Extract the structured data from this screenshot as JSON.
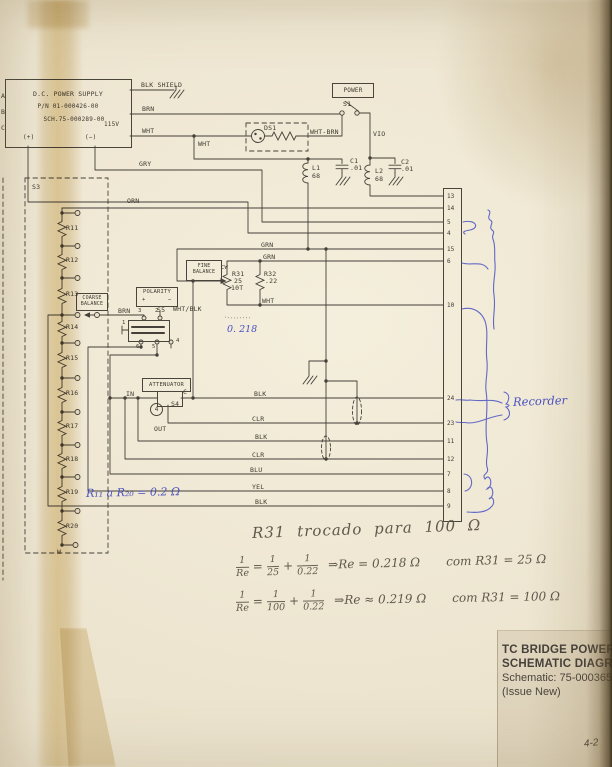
{
  "title_block": {
    "product": "TC BRIDGE POWER UNIT",
    "doc": "SCHEMATIC DIAGRAM",
    "schematic": "Schematic: 75-000365-00",
    "issue": "(Issue New)",
    "page": "4-2"
  },
  "power_supply": {
    "title": "D.C. POWER SUPPLY",
    "part": "P/N 01-000426-00",
    "sch": "SCH.75-000289-00",
    "voltage": "115V",
    "plus": "(+)",
    "minus": "(−)",
    "a": "A",
    "b": "B",
    "c": "C"
  },
  "wires": {
    "blk_shield": "BLK SHIELD",
    "brn": "BRN",
    "wht": "WHT",
    "wht_b": "WHT",
    "gry": "GRY",
    "orn": "ORN",
    "wht_brn": "WHT-BRN",
    "vio": "VIO",
    "grn_a": "GRN",
    "grn_b": "GRN",
    "wht_c": "WHT",
    "wht_blk": "WHT/BLK",
    "brn_b": "BRN",
    "blk_a": "BLK",
    "clr_a": "CLR",
    "blk_b": "BLK",
    "clr_b": "CLR",
    "blu": "BLU",
    "yel": "YEL",
    "blk_c": "BLK"
  },
  "components": {
    "power": "POWER",
    "s1": "S1",
    "ds1": "DS1",
    "s3": "S3",
    "s4": "S4",
    "s5": "S5",
    "l1": {
      "ref": "L1",
      "val": "68"
    },
    "l2": {
      "ref": "L2",
      "val": "68"
    },
    "c1": {
      "ref": "C1",
      "val": ".01"
    },
    "c2": {
      "ref": "C2",
      "val": ".01"
    },
    "r31": {
      "ref": "R31",
      "val": "25",
      "turns": "10T"
    },
    "r32": {
      "ref": "R32",
      "val": ".22"
    },
    "fine_balance": {
      "l1": "FINE",
      "l2": "BALANCE",
      "cw": "CW"
    },
    "coarse_balance": {
      "l1": "COARSE",
      "l2": "BALANCE"
    },
    "polarity": {
      "title": "POLARITY",
      "plus": "+",
      "minus": "−"
    },
    "attenuator": {
      "title": "ATTENUATOR",
      "in": "IN",
      "c": "C",
      "out": "OUT",
      "knob": "4"
    },
    "s5_pins": {
      "p1": "1",
      "p2": "2",
      "p3": "3",
      "p4": "4",
      "p5": "5",
      "p6": "6"
    },
    "ladder": {
      "r": [
        "R11",
        "R12",
        "R13",
        "R14",
        "R15",
        "R16",
        "R17",
        "R18",
        "R19",
        "R20"
      ],
      "w": "W"
    }
  },
  "connector": {
    "pins": [
      "13",
      "14",
      "5",
      "4",
      "15",
      "6",
      "10",
      "24",
      "23",
      "11",
      "12",
      "7",
      "8",
      "9"
    ]
  },
  "annotations": {
    "recorder": "Recorder",
    "ladder_note": "R₁₁ a R₂₀ = 0.2 Ω",
    "pot_note": "0. 218",
    "note_title": "R31 trocado para 100 Ω",
    "eq1": {
      "n1": "1",
      "d1": "Re",
      "eq": "=",
      "n2": "1",
      "d2": "25",
      "plus": "+",
      "n3": "1",
      "d3": "0.22",
      "res": "⇒Re = 0.218 Ω",
      "tail": "com R31 = 25 Ω"
    },
    "eq2": {
      "n1": "1",
      "d1": "Re",
      "eq": "=",
      "n2": "1",
      "d2": "100",
      "plus": "+",
      "n3": "1",
      "d3": "0.22",
      "res": "⇒Re ≈ 0.219 Ω",
      "tail": "com R31 = 100 Ω"
    }
  }
}
